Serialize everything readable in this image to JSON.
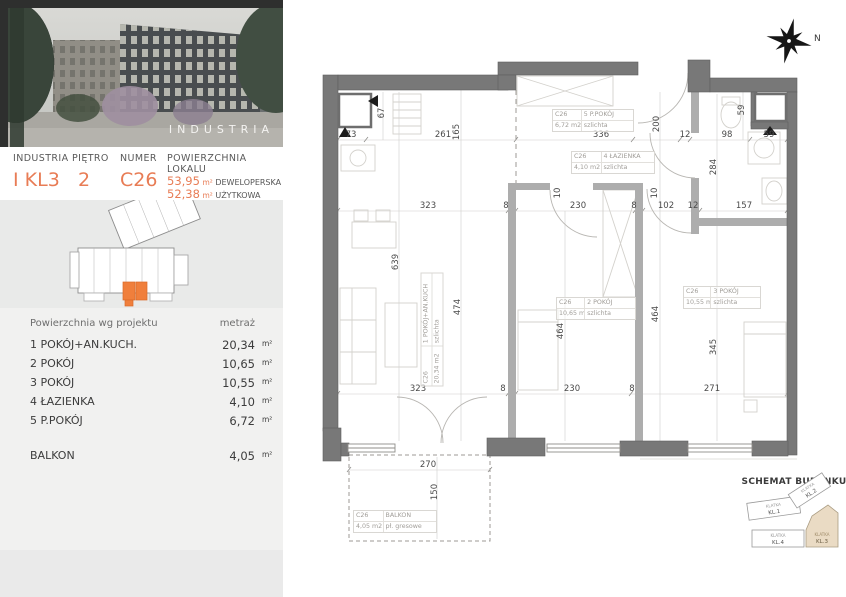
{
  "header": {
    "label_building": "INDUSTRIA",
    "label_floor": "PIĘTRO",
    "label_number": "NUMER",
    "label_area": "POWIERZCHNIA LOKALU",
    "value_building": "I KL3",
    "value_floor": "2",
    "value_number": "C26",
    "area_developer_value": "53,95",
    "area_developer_unit": "m²",
    "area_developer_label": "DEWELOPERSKA",
    "area_usable_value": "52,38",
    "area_usable_unit": "m²",
    "area_usable_label": "UŻYTKOWA"
  },
  "photo": {
    "watermark": "INDUSTRIA"
  },
  "areas_table": {
    "title": "Powierzchnia wg projektu",
    "col_header": "metraż",
    "rows": [
      {
        "name": "1 POKÓJ+AN.KUCH.",
        "value": "20,34",
        "unit": "m²"
      },
      {
        "name": "2 POKÓJ",
        "value": "10,65",
        "unit": "m²"
      },
      {
        "name": "3 POKÓJ",
        "value": "10,55",
        "unit": "m²"
      },
      {
        "name": "4 ŁAZIENKA",
        "value": "4,10",
        "unit": "m²"
      },
      {
        "name": "5 P.POKÓJ",
        "value": "6,72",
        "unit": "m²"
      }
    ],
    "balcony_row": {
      "name": "BALKON",
      "value": "4,05",
      "unit": "m²"
    }
  },
  "plan": {
    "compass_label": "N",
    "room_labels": [
      {
        "id": "C26",
        "name": "5 P.POKÓJ",
        "area": "6,72 m2",
        "finish": "szlichta"
      },
      {
        "id": "C26",
        "name": "4 ŁAZIENKA",
        "area": "4,10 m2",
        "finish": "szlichta"
      },
      {
        "id": "C26",
        "name": "1 POKÓJ+AN.KUCH",
        "area": "20,34 m2",
        "finish": "szlichta"
      },
      {
        "id": "C26",
        "name": "2 POKÓJ",
        "area": "10,65 m2",
        "finish": "szlichta"
      },
      {
        "id": "C26",
        "name": "3 POKÓJ",
        "area": "10,55 m2",
        "finish": "szlichta"
      },
      {
        "id": "C26",
        "name": "BALKON",
        "area": "4,05 m2",
        "finish": "pł. gresowe"
      }
    ],
    "dims": [
      "73",
      "67",
      "261",
      "165",
      "336",
      "12",
      "98",
      "59",
      "59",
      "200",
      "323",
      "8",
      "230",
      "8",
      "102",
      "12",
      "157",
      "10",
      "10",
      "284",
      "639",
      "474",
      "464",
      "464",
      "345",
      "323",
      "8",
      "230",
      "8",
      "271",
      "270",
      "150"
    ]
  },
  "schemat": {
    "title": "SCHEMAT BUDYNKU",
    "blocks": [
      {
        "line1": "KLATKA",
        "line2": "KL.1"
      },
      {
        "line1": "KLATKA",
        "line2": "KL.2"
      },
      {
        "line1": "KLATKA",
        "line2": "KL.4"
      },
      {
        "line1": "KLATKA",
        "line2": "KL.3"
      }
    ],
    "highlight_color": "#eadbc4"
  },
  "colors": {
    "accent": "#e87c55",
    "unit_highlight": "#f07f3c",
    "wall": "#787878",
    "inner_wall": "#adadad"
  }
}
